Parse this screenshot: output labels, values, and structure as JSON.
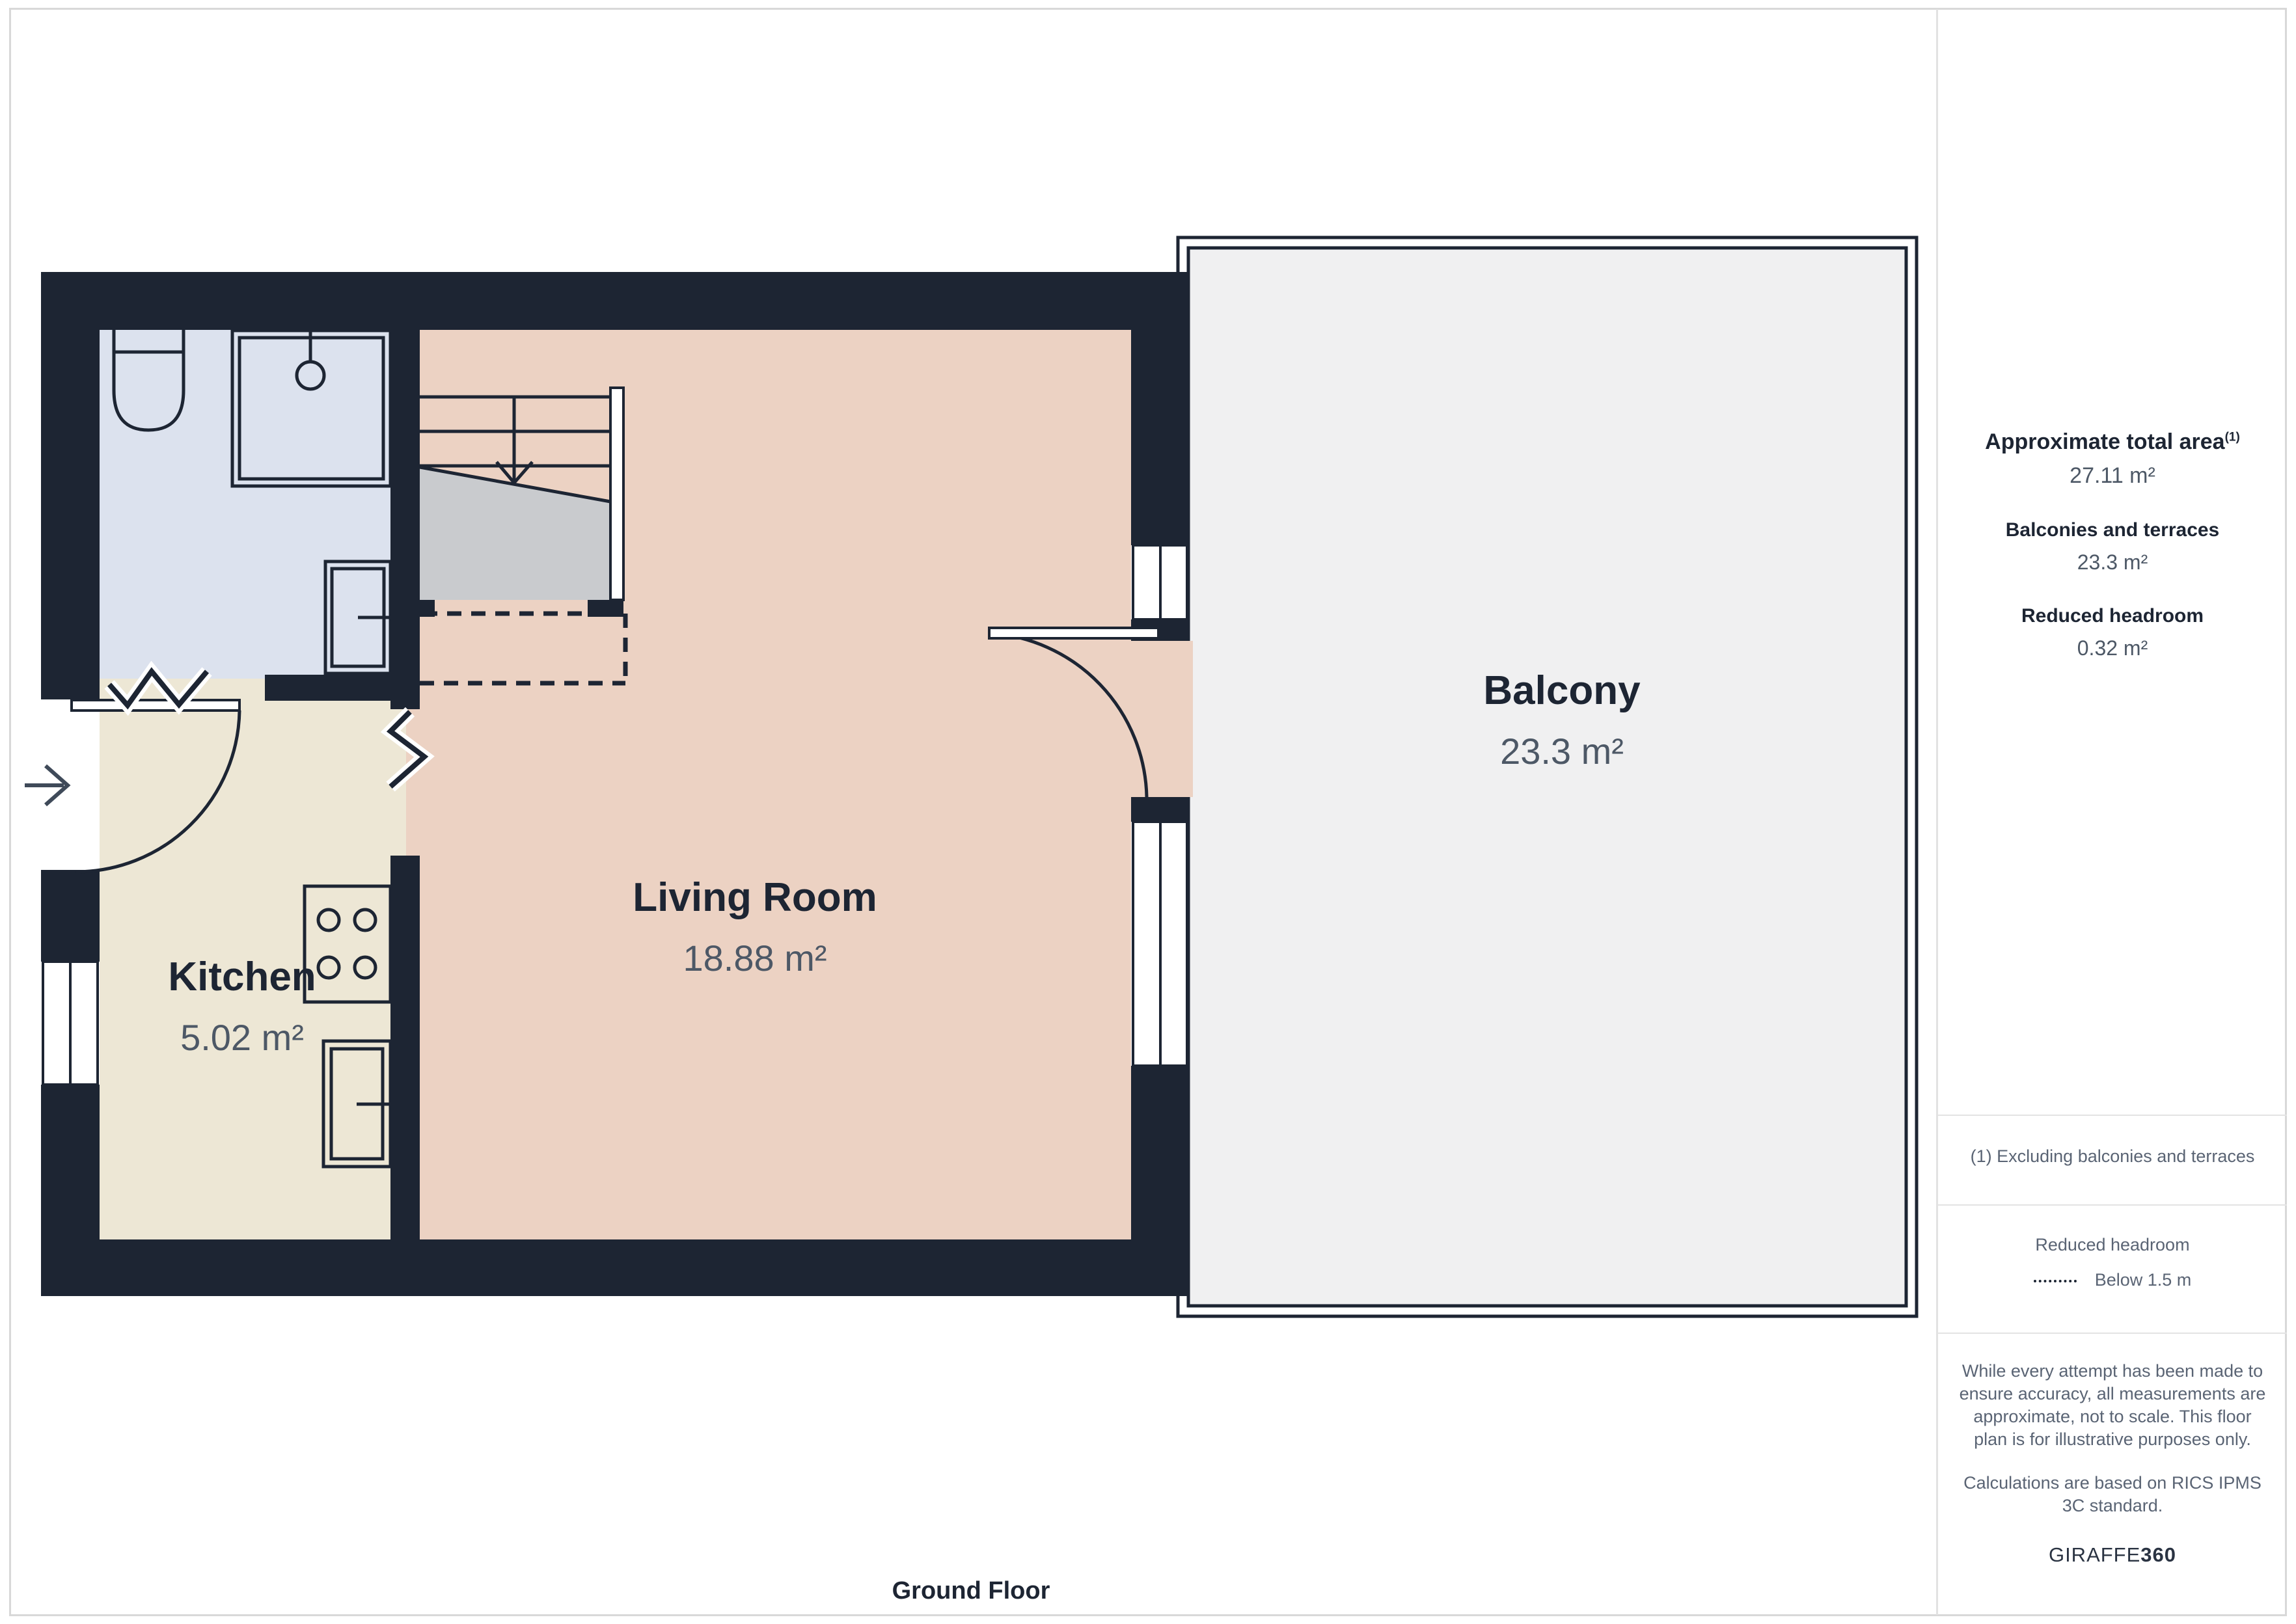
{
  "page": {
    "floor_label": "Ground Floor"
  },
  "rooms": {
    "living_room": {
      "name": "Living Room",
      "area": "18.88 m²"
    },
    "kitchen": {
      "name": "Kitchen",
      "area": "5.02 m²"
    },
    "balcony": {
      "name": "Balcony",
      "area": "23.3 m²"
    }
  },
  "sidebar": {
    "total_area": {
      "label": "Approximate total area",
      "footnote_marker": "(1)",
      "value": "27.11 m²"
    },
    "balconies": {
      "label": "Balconies and terraces",
      "value": "23.3 m²"
    },
    "reduced_headroom": {
      "label": "Reduced headroom",
      "value": "0.32 m²"
    },
    "footnote": "(1) Excluding balconies and terraces",
    "legend": {
      "title": "Reduced headroom",
      "item": "Below 1.5 m"
    },
    "disclaimer1": "While every attempt has been made to ensure accuracy, all measurements are approximate, not to scale. This floor plan is for illustrative purposes only.",
    "disclaimer2": "Calculations are based on RICS IPMS 3C standard.",
    "brand": {
      "name": "GIRAFFE",
      "suffix": "360"
    }
  },
  "colors": {
    "wall": "#1d2533",
    "living_room": "#ecd2c3",
    "kitchen": "#ede7d5",
    "bathroom": "#dce2ee",
    "balcony": "#f0f0f1",
    "stairs_shadow": "#c9cbce",
    "label_text": "#1d2533",
    "value_text": "#4d5866"
  }
}
